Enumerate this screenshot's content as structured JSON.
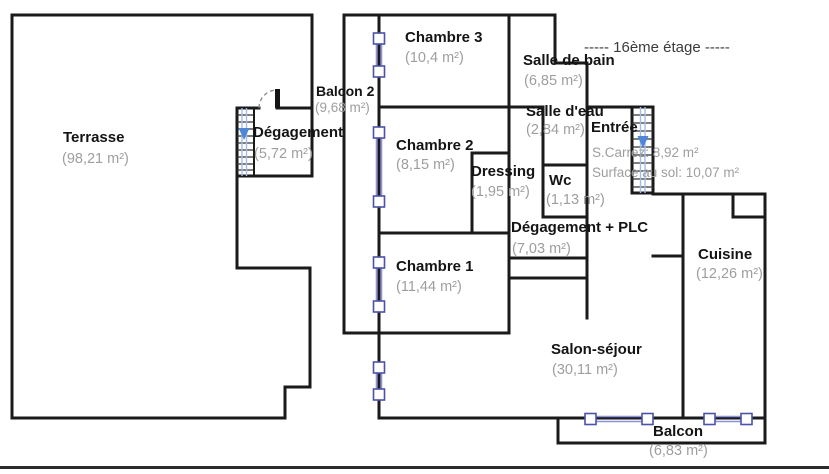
{
  "floor_label": "-----  16ème étage  -----",
  "rooms": {
    "terrasse": {
      "name": "Terrasse",
      "area": "(98,21 m²)"
    },
    "degagement": {
      "name": "Dégagement",
      "area": "(5,72 m²)"
    },
    "balcon2": {
      "name": "Balcon 2",
      "area": "(9,68 m²)"
    },
    "chambre3": {
      "name": "Chambre 3",
      "area": "(10,4 m²)"
    },
    "salledebain": {
      "name": "Salle de bain",
      "area": "(6,85 m²)"
    },
    "salledeau": {
      "name": "Salle d'eau",
      "area": "(2,84 m²)"
    },
    "entree": {
      "name": "Entrée",
      "carrez": "S.Carrez: 8,92 m²",
      "surface": "Surface au sol: 10,07 m²"
    },
    "chambre2": {
      "name": "Chambre 2",
      "area": "(8,15 m²)"
    },
    "dressing": {
      "name": "Dressing",
      "area": "(1,95 m²)"
    },
    "wc": {
      "name": "Wc",
      "area": "(1,13 m²)"
    },
    "degplc": {
      "name": "Dégagement + PLC",
      "area": "(7,03 m²)"
    },
    "chambre1": {
      "name": "Chambre 1",
      "area": "(11,44 m²)"
    },
    "cuisine": {
      "name": "Cuisine",
      "area": "(12,26 m²)"
    },
    "salon": {
      "name": "Salon-séjour",
      "area": "(30,11 m²)"
    },
    "balcon": {
      "name": "Balcon",
      "area": "(6,83 m²)"
    }
  },
  "icons": {
    "window": "window-icon",
    "stairs": "stairs-down-icon",
    "door": "door-swing-icon"
  },
  "colors": {
    "wall": "#1a1a1a",
    "window_frame": "#4c52a8",
    "window_glass": "#8d92dd",
    "stairs_arrow": "#4f86d8",
    "stairs_shaft": "#a3bde8",
    "area_text": "#9e9e9e",
    "name_text": "#141414"
  }
}
